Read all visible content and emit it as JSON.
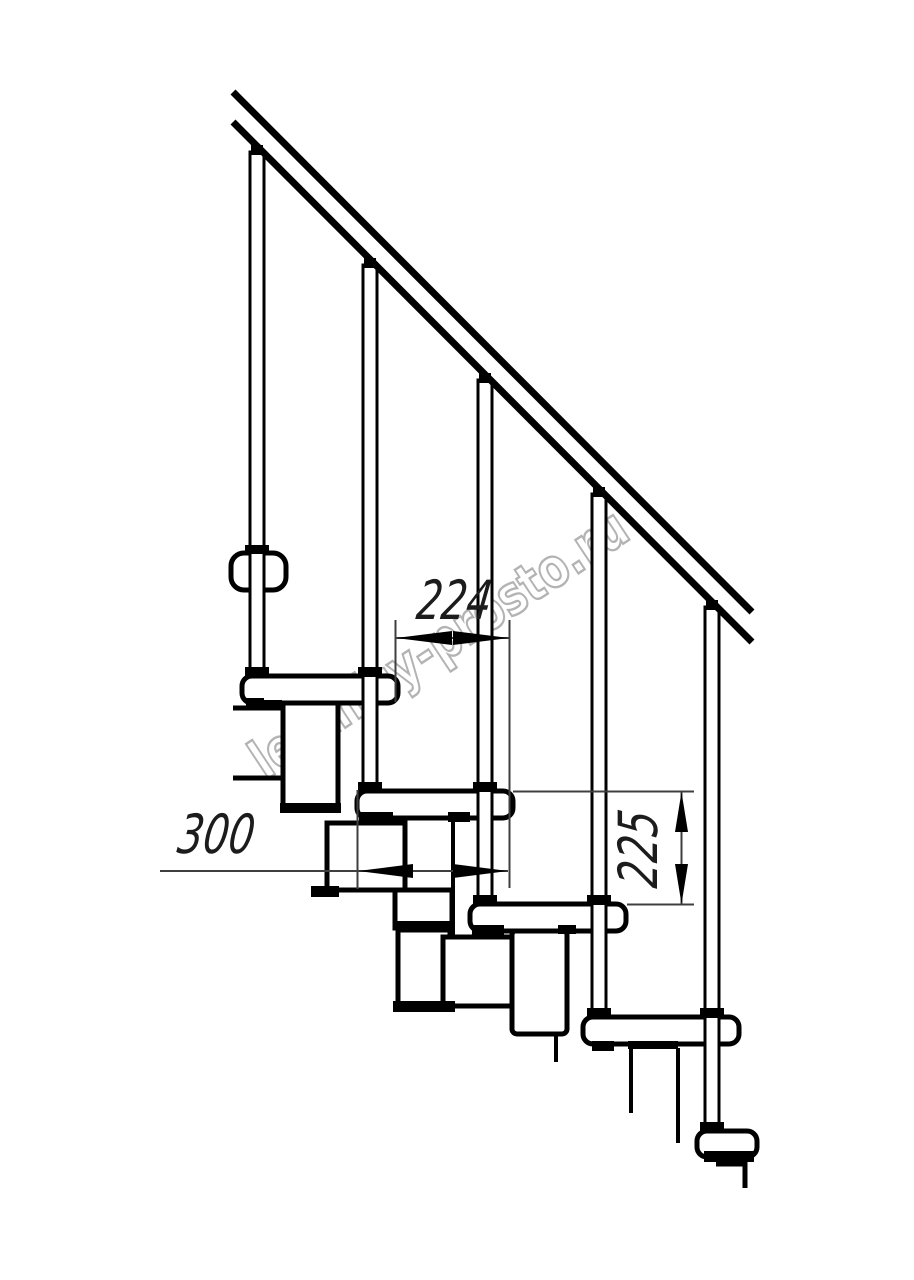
{
  "drawing": {
    "title": "modular-staircase-side-elevation",
    "labels": {
      "dim_step_run": "224",
      "dim_tread_depth": "300",
      "dim_riser_height": "225"
    },
    "watermark": {
      "text": "lestnicy-prosto.ru",
      "color": "#b3b3b3"
    },
    "colors": {
      "background": "#ffffff",
      "ink": "#000000",
      "dimension_lines": "#3f3f3f",
      "dimension_text": "#1c1c1c"
    }
  },
  "css_vars": {
    "--bg": "#ffffff",
    "--ink": "#000000",
    "--dim": "#3f3f3f",
    "--dim-text": "#1c1c1c",
    "--wm": "#b3b3b3"
  }
}
